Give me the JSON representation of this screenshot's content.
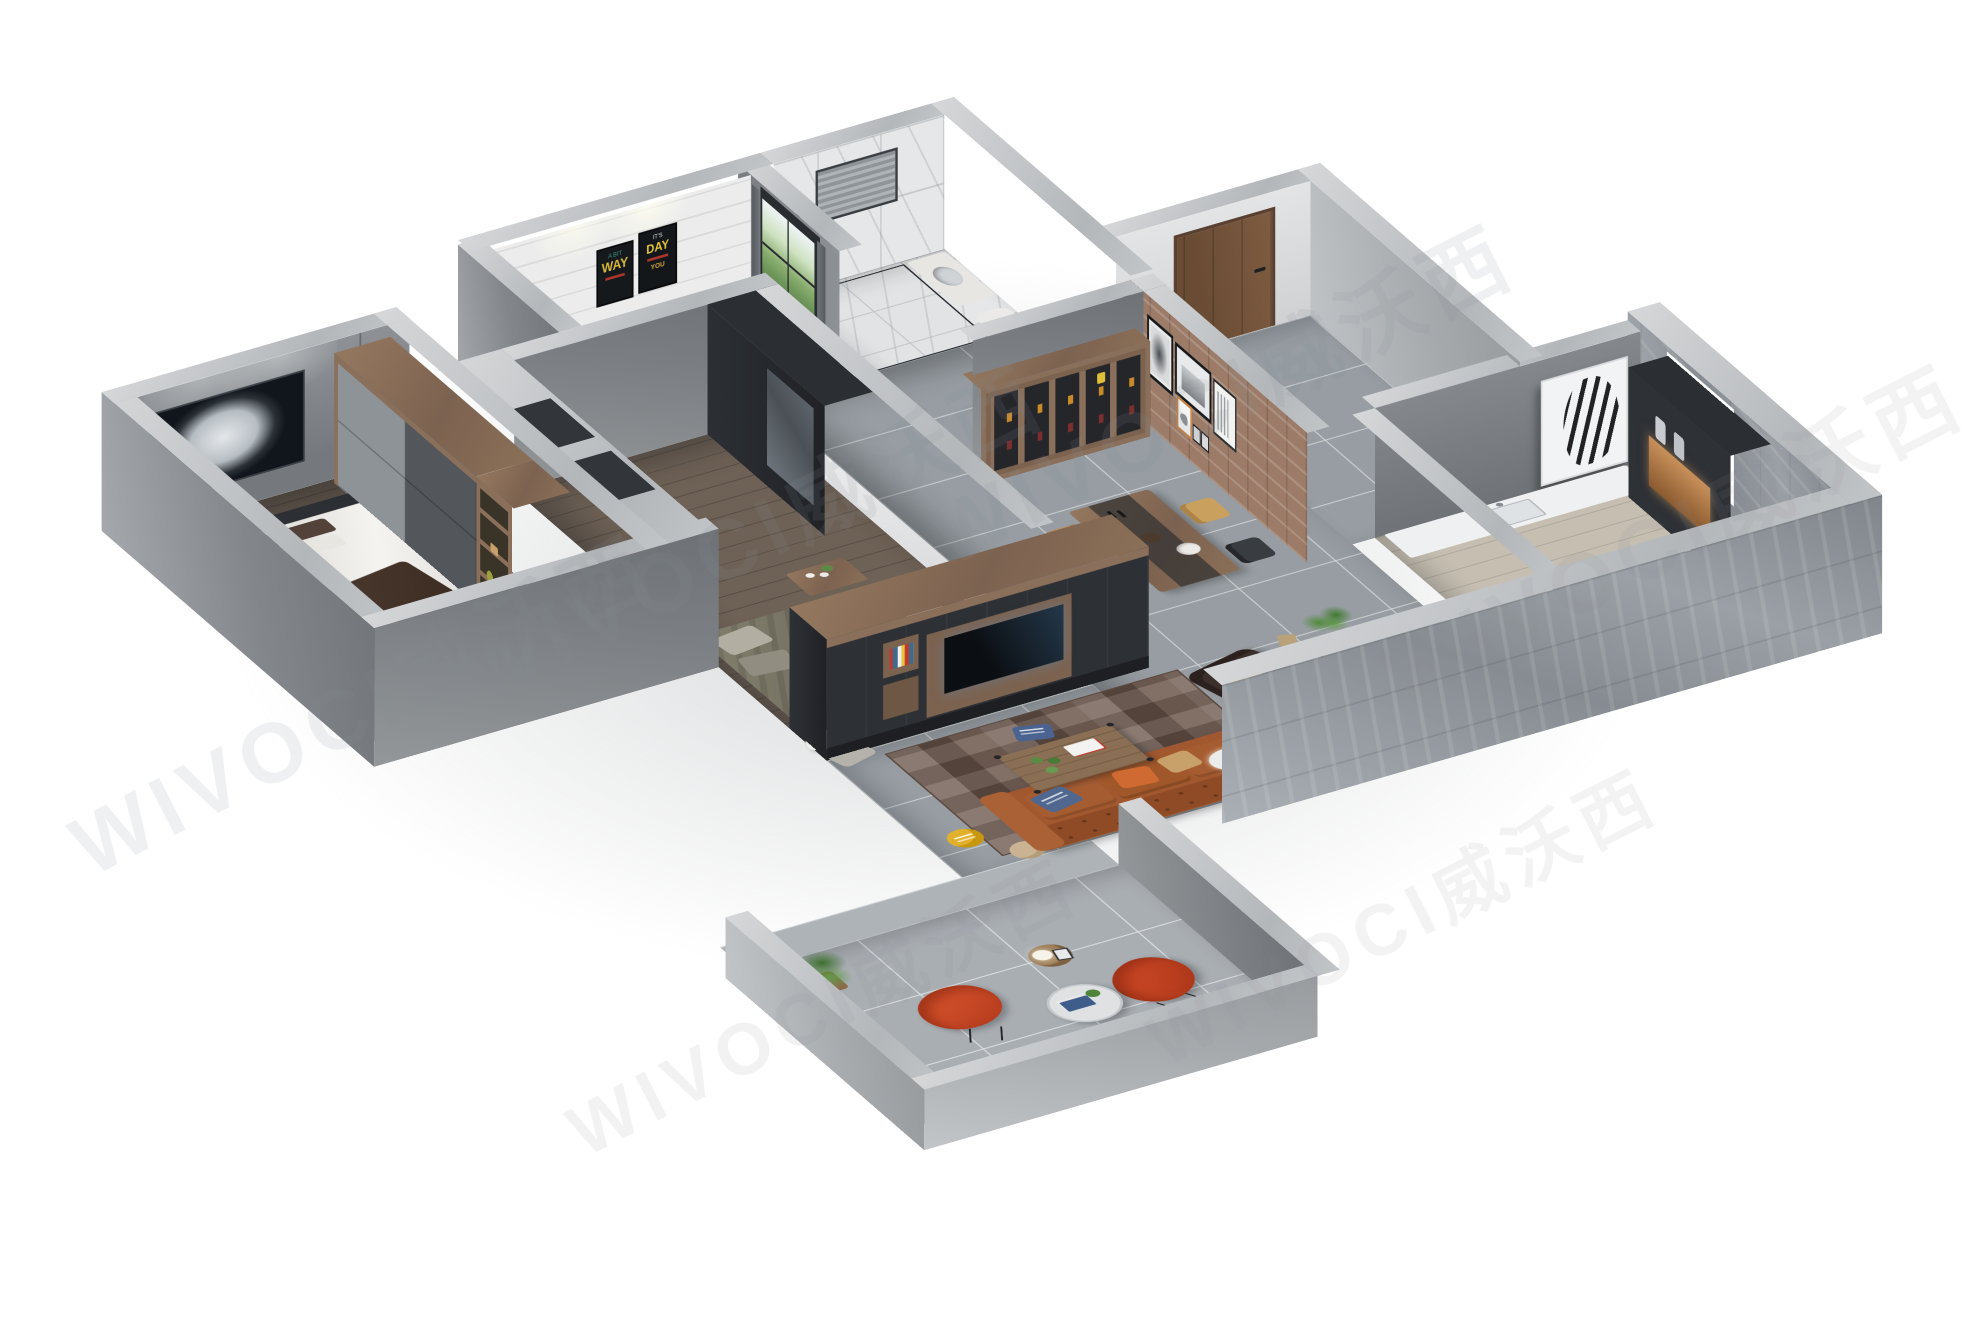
{
  "scene_type": "3d-isometric-apartment-dollhouse-render",
  "background_color": "#ffffff",
  "watermark": {
    "text": "WIVOCI威沃西",
    "color": "#8b9197"
  },
  "bedroom3": {
    "poster1_small_text": "IT'S",
    "poster1_word": "DAY",
    "poster1_bottom": "YOU",
    "poster2_top": "A BIT",
    "poster2_word": "WAY"
  },
  "palette": {
    "concrete_top": "#c9cbce",
    "concrete_face": "#83878b",
    "stone_face": "#8f959a",
    "floor_tile": "#979da2",
    "floor_wood": "#6b5e53",
    "marble": "#e6e7e8",
    "walnut_wood": "#8a6f5a",
    "charcoal_furniture": "#32363b",
    "white_plank_wall": "#ececec",
    "brick_wall": "#9c7c68",
    "leather_sofa": "#a2582f",
    "accent_red_chair": "#d8502c",
    "accent_yellow": "#e5b41d",
    "accent_teal": "#149a90",
    "accent_orange": "#cf6a33",
    "plant_green": "#4e8438",
    "rug_brown": "#6e594e"
  }
}
